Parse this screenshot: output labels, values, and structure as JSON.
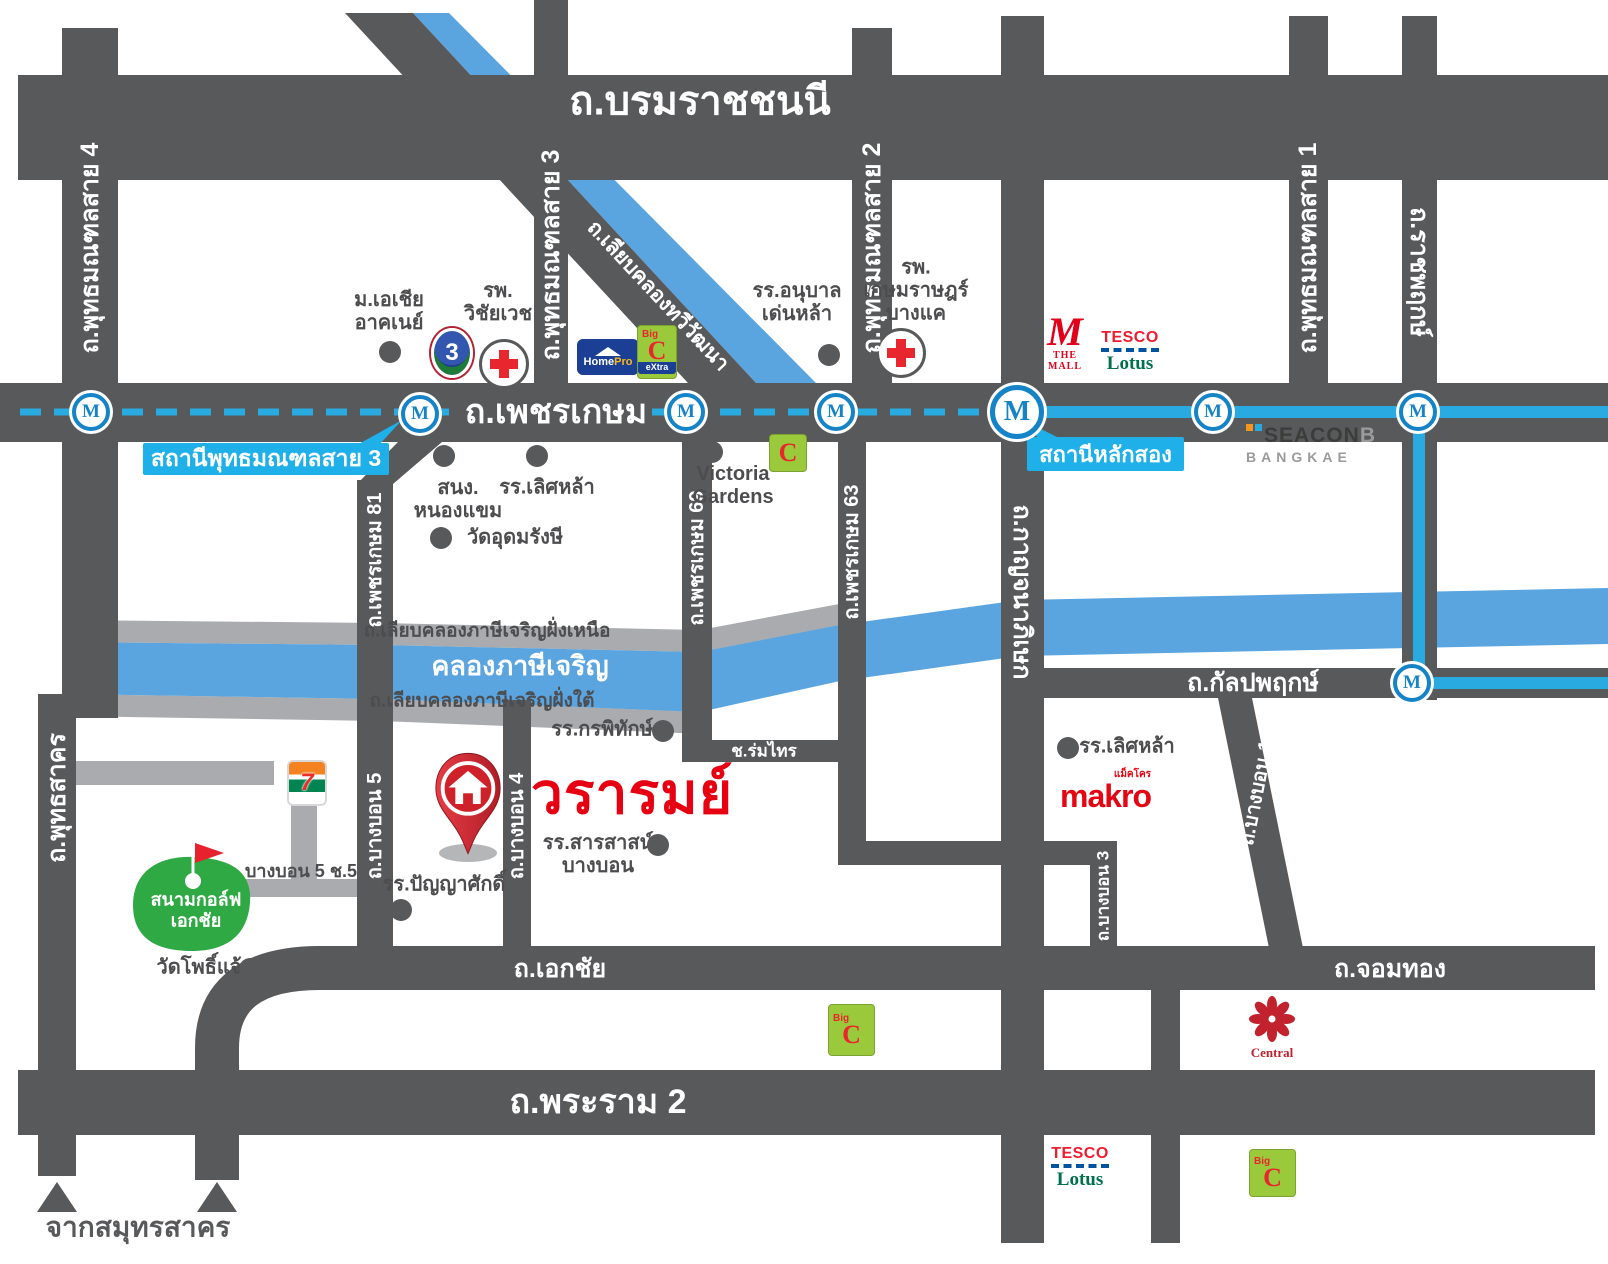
{
  "project": {
    "name": "วรารมย์"
  },
  "mrt": {
    "symbol": "M",
    "stations": [
      {
        "id": "m1",
        "x": 91,
        "y": 412,
        "big": false
      },
      {
        "id": "m2",
        "x": 420,
        "y": 414,
        "big": false
      },
      {
        "id": "m3",
        "x": 686,
        "y": 412,
        "big": false
      },
      {
        "id": "m4",
        "x": 836,
        "y": 412,
        "big": false
      },
      {
        "id": "m-laksong",
        "x": 1017,
        "y": 412,
        "big": true
      },
      {
        "id": "m6",
        "x": 1213,
        "y": 412,
        "big": false
      },
      {
        "id": "m7",
        "x": 1418,
        "y": 412,
        "big": false
      },
      {
        "id": "m-kanlapaphruek",
        "x": 1412,
        "y": 683,
        "big": false
      }
    ],
    "callouts": [
      {
        "id": "phutthamonthon-sai3-station",
        "text": "สถานีพุทธมณฑลสาย 3"
      },
      {
        "id": "laksong-station",
        "text": "สถานีหลักสอง"
      }
    ]
  },
  "labels": [
    {
      "id": "borommaratchachonnani",
      "text": "ถ.บรมราชชนนี",
      "x": 700,
      "y": 102,
      "rot": 0,
      "cls": "road-xl"
    },
    {
      "id": "phetkasem",
      "text": "ถ.เพชรเกษม",
      "x": 556,
      "y": 412,
      "rot": 0,
      "cls": "road-lg"
    },
    {
      "id": "rama2",
      "text": "ถ.พระราม 2",
      "x": 598,
      "y": 1102,
      "rot": 0,
      "cls": "road-lg"
    },
    {
      "id": "ekkachai",
      "text": "ถ.เอกชัย",
      "x": 560,
      "y": 969,
      "rot": 0,
      "cls": "road-md"
    },
    {
      "id": "chomthong",
      "text": "ถ.จอมทอง",
      "x": 1390,
      "y": 969,
      "rot": 0,
      "cls": "road-md"
    },
    {
      "id": "kanlapaphruek",
      "text": "ถ.กัลปพฤกษ์",
      "x": 1253,
      "y": 683,
      "rot": 0,
      "cls": "road-md"
    },
    {
      "id": "phutthamonthon-4",
      "text": "ถ.พุทธมณฑลสาย 4",
      "x": 90,
      "y": 248,
      "rot": -90,
      "cls": "road-v"
    },
    {
      "id": "phutthamonthon-3",
      "text": "ถ.พุทธมณฑลสาย 3",
      "x": 551,
      "y": 255,
      "rot": -90,
      "cls": "road-v"
    },
    {
      "id": "phutthamonthon-2",
      "text": "ถ.พุทธมณฑลสาย 2",
      "x": 872,
      "y": 248,
      "rot": -90,
      "cls": "road-v"
    },
    {
      "id": "phutthamonthon-1",
      "text": "ถ.พุทธมณฑลสาย 1",
      "x": 1308,
      "y": 248,
      "rot": -90,
      "cls": "road-v"
    },
    {
      "id": "ratchaphruek",
      "text": "ถ.ราชพฤกษ์",
      "x": 1419,
      "y": 272,
      "rot": 90,
      "cls": "road-v"
    },
    {
      "id": "kanchanaphisek",
      "text": "ถ.กาญจนาภิเษก",
      "x": 1022,
      "y": 592,
      "rot": 90,
      "cls": "road-v"
    },
    {
      "id": "liap-khlong-thawiwatthana",
      "text": "ถ.เลียบคลองทวีวัฒนา",
      "x": 658,
      "y": 296,
      "rot": 47,
      "cls": "road-diag"
    },
    {
      "id": "phetkasem-81",
      "text": "ถ.เพชรเกษม 81",
      "x": 375,
      "y": 560,
      "rot": -90,
      "cls": "road-vs"
    },
    {
      "id": "phetkasem-69",
      "text": "ถ.เพชรเกษม 69",
      "x": 697,
      "y": 558,
      "rot": -90,
      "cls": "road-vs"
    },
    {
      "id": "phetkasem-63",
      "text": "ถ.เพชรเกษม 63",
      "x": 852,
      "y": 552,
      "rot": -90,
      "cls": "road-vs"
    },
    {
      "id": "phuttha-sakhon",
      "text": "ถ.พุทธสาคร",
      "x": 57,
      "y": 798,
      "rot": -90,
      "cls": "road-v"
    },
    {
      "id": "bangbon-5",
      "text": "ถ.บางบอน 5",
      "x": 375,
      "y": 826,
      "rot": -90,
      "cls": "road-vs"
    },
    {
      "id": "bangbon-4",
      "text": "ถ.บางบอน 4",
      "x": 517,
      "y": 826,
      "rot": -90,
      "cls": "road-vs"
    },
    {
      "id": "bangbon-3",
      "text": "ถ.บางบอน 3",
      "x": 1103,
      "y": 896,
      "rot": -90,
      "cls": "road-vs2"
    },
    {
      "id": "bangbon-1",
      "text": "ถ.บางบอน 1",
      "x": 1257,
      "y": 793,
      "rot": -79,
      "cls": "road-vs"
    },
    {
      "id": "soi-romsai",
      "text": "ช.ร่มไทร",
      "x": 764,
      "y": 751,
      "rot": 0,
      "cls": "road-xs"
    },
    {
      "id": "liap-khlong-nuea",
      "text": "ถ.เลียบคลองภาษีเจริญฝั่งเหนือ",
      "x": 487,
      "y": 631,
      "rot": 0,
      "cls": "gray-road"
    },
    {
      "id": "khlong-phasi-charoen",
      "text": "คลองภาษีเจริญ",
      "x": 520,
      "y": 666,
      "rot": 0,
      "cls": "canal"
    },
    {
      "id": "liap-khlong-tai",
      "text": "ถ.เลียบคลองภาษีเจริญฝั่งใต้",
      "x": 482,
      "y": 701,
      "rot": 0,
      "cls": "gray-road"
    },
    {
      "id": "bangbon5-soi5",
      "text": "บางบอน 5 ช.5",
      "x": 301,
      "y": 871,
      "rot": 0,
      "cls": "sidelabel"
    },
    {
      "id": "from-samut-sakhon",
      "text": "จากสมุทรสาคร",
      "x": 138,
      "y": 1227,
      "rot": 0,
      "cls": "fromlabel"
    },
    {
      "id": "asia-university",
      "text": "ม.เอเชีย\nอาคเนย์",
      "x": 389,
      "y": 312,
      "rot": 0,
      "cls": "lm"
    },
    {
      "id": "wichaiwet-hospital",
      "text": "รพ.\nวิชัยเวช",
      "x": 498,
      "y": 303,
      "rot": 0,
      "cls": "lm"
    },
    {
      "id": "denla-kindergarten",
      "text": "รร.อนุบาล\nเด่นหล้า",
      "x": 797,
      "y": 303,
      "rot": 0,
      "cls": "lm"
    },
    {
      "id": "kasemrat-hospital",
      "text": "รพ.\nเกษมราษฎร์\nบางแค",
      "x": 916,
      "y": 291,
      "rot": 0,
      "cls": "lm"
    },
    {
      "id": "nong-khaem-office",
      "text": "สนง.\nหนองแขม",
      "x": 458,
      "y": 500,
      "rot": 0,
      "cls": "lm"
    },
    {
      "id": "lertla-school",
      "text": "รร.เลิศหล้า",
      "x": 547,
      "y": 488,
      "rot": 0,
      "cls": "lm"
    },
    {
      "id": "victoria-gardens",
      "text": "Victoria\nGardens",
      "x": 733,
      "y": 486,
      "rot": 0,
      "cls": "lm"
    },
    {
      "id": "wat-udomrangsi",
      "text": "วัดอุดมรังษี",
      "x": 515,
      "y": 538,
      "rot": 0,
      "cls": "lm"
    },
    {
      "id": "kornpitak-school",
      "text": "รร.กรพิทักษ์",
      "x": 602,
      "y": 730,
      "rot": 0,
      "cls": "lm"
    },
    {
      "id": "sarasas-bangbon-school",
      "text": "รร.สารสาสน์\nบางบอน",
      "x": 598,
      "y": 855,
      "rot": 0,
      "cls": "lm"
    },
    {
      "id": "panyasak-school",
      "text": "รร.ปัญญาศักดิ์",
      "x": 444,
      "y": 885,
      "rot": 0,
      "cls": "lm"
    },
    {
      "id": "lertla-school-2",
      "text": "รร.เลิศหล้า",
      "x": 1127,
      "y": 747,
      "rot": 0,
      "cls": "lm"
    },
    {
      "id": "wat-pho-chae",
      "text": "วัดโพธิ์แจ้",
      "x": 199,
      "y": 968,
      "rot": 0,
      "cls": "lm"
    },
    {
      "id": "ekachai-golf",
      "text": "สนามกอล์ฟ\nเอกชัย",
      "x": 196,
      "y": 910,
      "rot": 0,
      "cls": "golf-lbl"
    },
    {
      "id": "project-name",
      "text": "วรารมย์",
      "x": 632,
      "y": 795,
      "rot": 0,
      "cls": "project"
    }
  ],
  "dots": [
    {
      "x": 390,
      "y": 352
    },
    {
      "x": 829,
      "y": 355
    },
    {
      "x": 444,
      "y": 456
    },
    {
      "x": 537,
      "y": 456
    },
    {
      "x": 712,
      "y": 452
    },
    {
      "x": 441,
      "y": 538
    },
    {
      "x": 663,
      "y": 731
    },
    {
      "x": 658,
      "y": 845
    },
    {
      "x": 401,
      "y": 910
    },
    {
      "x": 1068,
      "y": 748
    },
    {
      "x": 250,
      "y": 969
    }
  ],
  "logos": {
    "homepro": {
      "home": "Home",
      "pro": "Pro"
    },
    "bigc": {
      "big": "Big",
      "c": "C",
      "extra": "eXtra"
    },
    "ch3": {
      "digit": "3"
    },
    "themall": {
      "m": "M",
      "text": "THE MALL"
    },
    "tesco": {
      "line1": "TESCO",
      "line2": "Lotus"
    },
    "seacon": {
      "line1": "SEACON",
      "b": "B",
      "line2": "BANGKAE"
    },
    "makro": {
      "text": "makro",
      "thai": "แม็คโคร"
    },
    "seven": {
      "digit": "7"
    },
    "central": {
      "text": "Central"
    }
  },
  "colors": {
    "road": "#58595b",
    "gray_road": "#a9abae",
    "canal": "#5aa5e0",
    "mrt_line": "#29abe2",
    "callout": "#1fb0ea",
    "project_red": "#e60011"
  }
}
